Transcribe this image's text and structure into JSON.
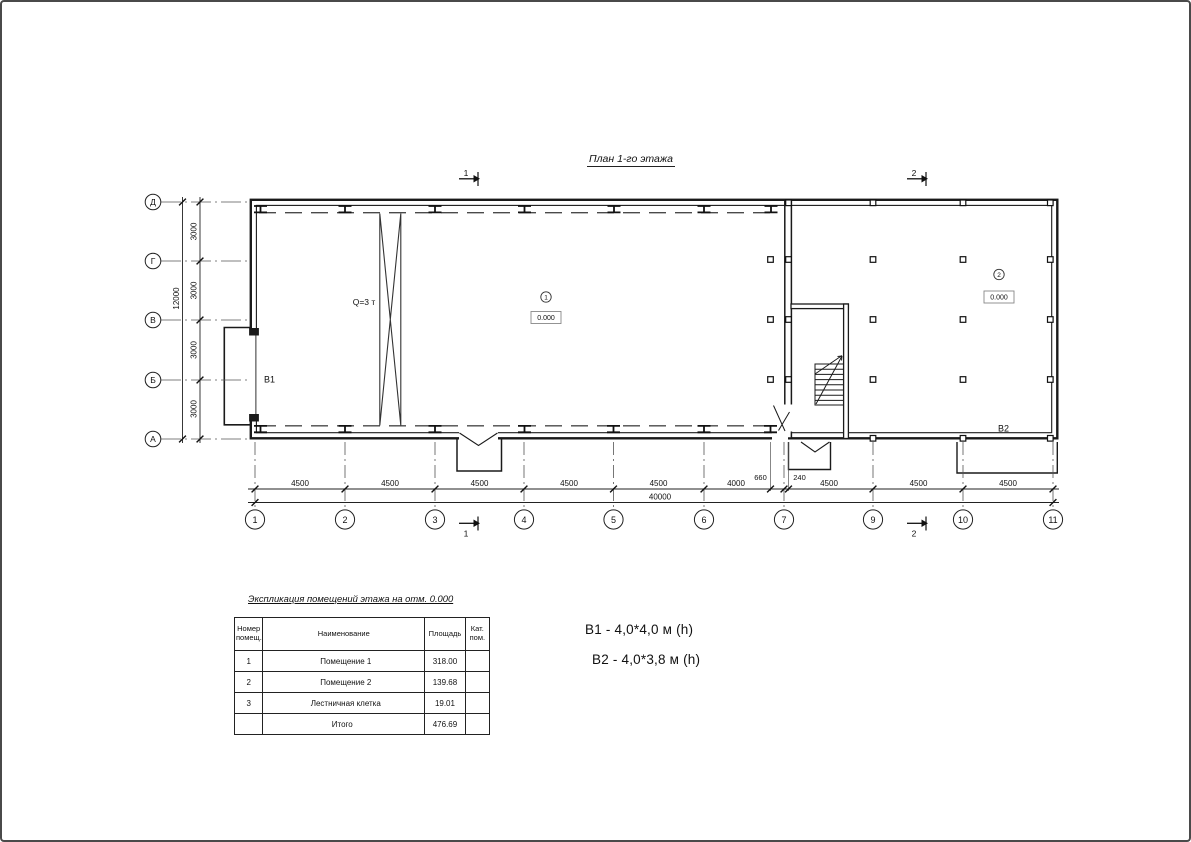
{
  "page_title": "План 1-го этажа",
  "plan": {
    "crane_label": "Q=3 т",
    "room1_number": "1",
    "room1_level": "0.000",
    "room2_number": "2",
    "room2_level": "0.000",
    "gate1_label": "В1",
    "gate2_label": "В2"
  },
  "axes": {
    "left": [
      "Д",
      "Г",
      "В",
      "Б",
      "А"
    ],
    "bottom": [
      "1",
      "2",
      "3",
      "4",
      "5",
      "6",
      "7",
      "9",
      "10",
      "11"
    ]
  },
  "dims": {
    "left_segments": [
      "3000",
      "3000",
      "3000",
      "3000"
    ],
    "left_total": "12000",
    "bottom_segments": [
      "4500",
      "4500",
      "4500",
      "4500",
      "4500",
      "4000",
      "4500",
      "4500",
      "4500"
    ],
    "dim_660": "660",
    "dim_240": "240",
    "bottom_total": "40000"
  },
  "sections": {
    "s1": "1",
    "s2": "2"
  },
  "table": {
    "title": "Экспликация помещений этажа на отм. 0.000",
    "headers": [
      "Номер помещ.",
      "Наименование",
      "Площадь",
      "Кат. пом."
    ],
    "rows": [
      {
        "num": "1",
        "name": "Помещение 1",
        "area": "318.00",
        "cat": ""
      },
      {
        "num": "2",
        "name": "Помещение 2",
        "area": "139.68",
        "cat": ""
      },
      {
        "num": "3",
        "name": "Лестничная клетка",
        "area": "19.01",
        "cat": ""
      }
    ],
    "total_label": "Итого",
    "total_value": "476.69"
  },
  "notes": {
    "note1": "В1  -  4,0*4,0 м (h)",
    "note2": "В2 - 4,0*3,8 м (h)"
  }
}
